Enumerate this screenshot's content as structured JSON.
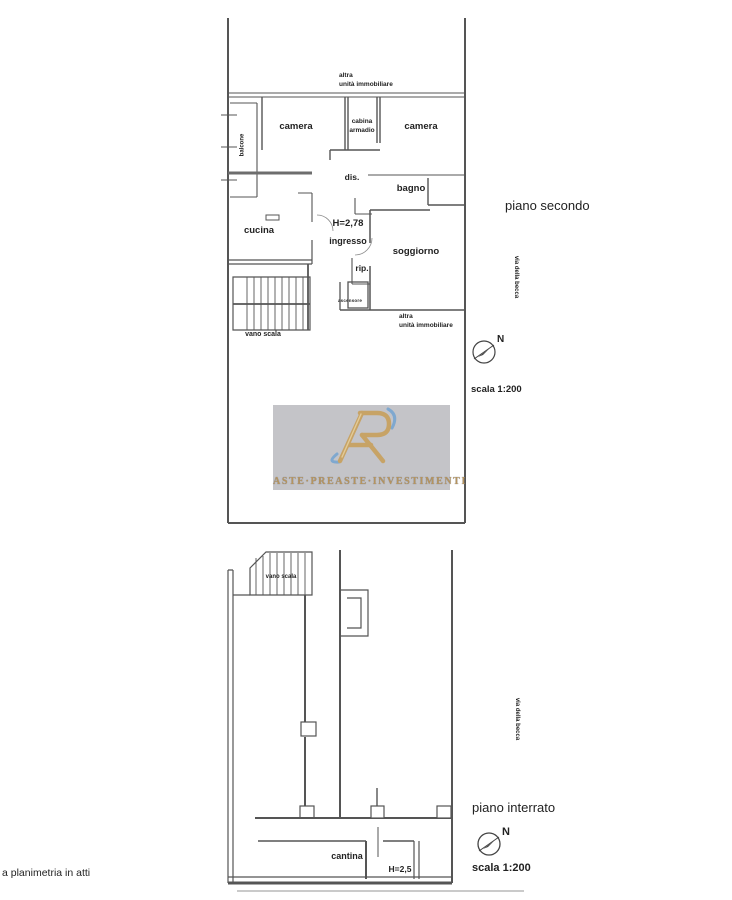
{
  "upper_plan": {
    "name_label": "piano secondo",
    "street": "via della becca",
    "north": "N",
    "scale": "scala 1:200",
    "neighbor_top": [
      "altra",
      "unità immobiliare"
    ],
    "neighbor_bottom": [
      "altra",
      "unità immobiliare"
    ],
    "rooms": {
      "balcone": "balcone",
      "camera_left": "camera",
      "cabina_armadio": [
        "cabina",
        "armadio"
      ],
      "camera_right": "camera",
      "disimpegno": "dis.",
      "bagno": "bagno",
      "cucina": "cucina",
      "ceiling_height": "H=2,78",
      "ingresso": "ingresso",
      "soggiorno": "soggiorno",
      "ripostiglio": "rip.",
      "ascensore": "ascensore",
      "vano_scala": "vano scala"
    }
  },
  "lower_plan": {
    "name_label": "piano interrato",
    "street": "via della becca",
    "north": "N",
    "scale": "scala 1:200",
    "rooms": {
      "vano_scala": "vano scala",
      "cantina": "cantina",
      "ceiling_height": "H=2,5"
    }
  },
  "watermark": {
    "brand_text": "ASTE·PREASTE·INVESTIMENTI",
    "panel_color": "#c4c4c8",
    "gold_color": "#c7a366",
    "blue_color": "#7fa8cf"
  },
  "footer": {
    "note": "a planimetria in atti"
  }
}
